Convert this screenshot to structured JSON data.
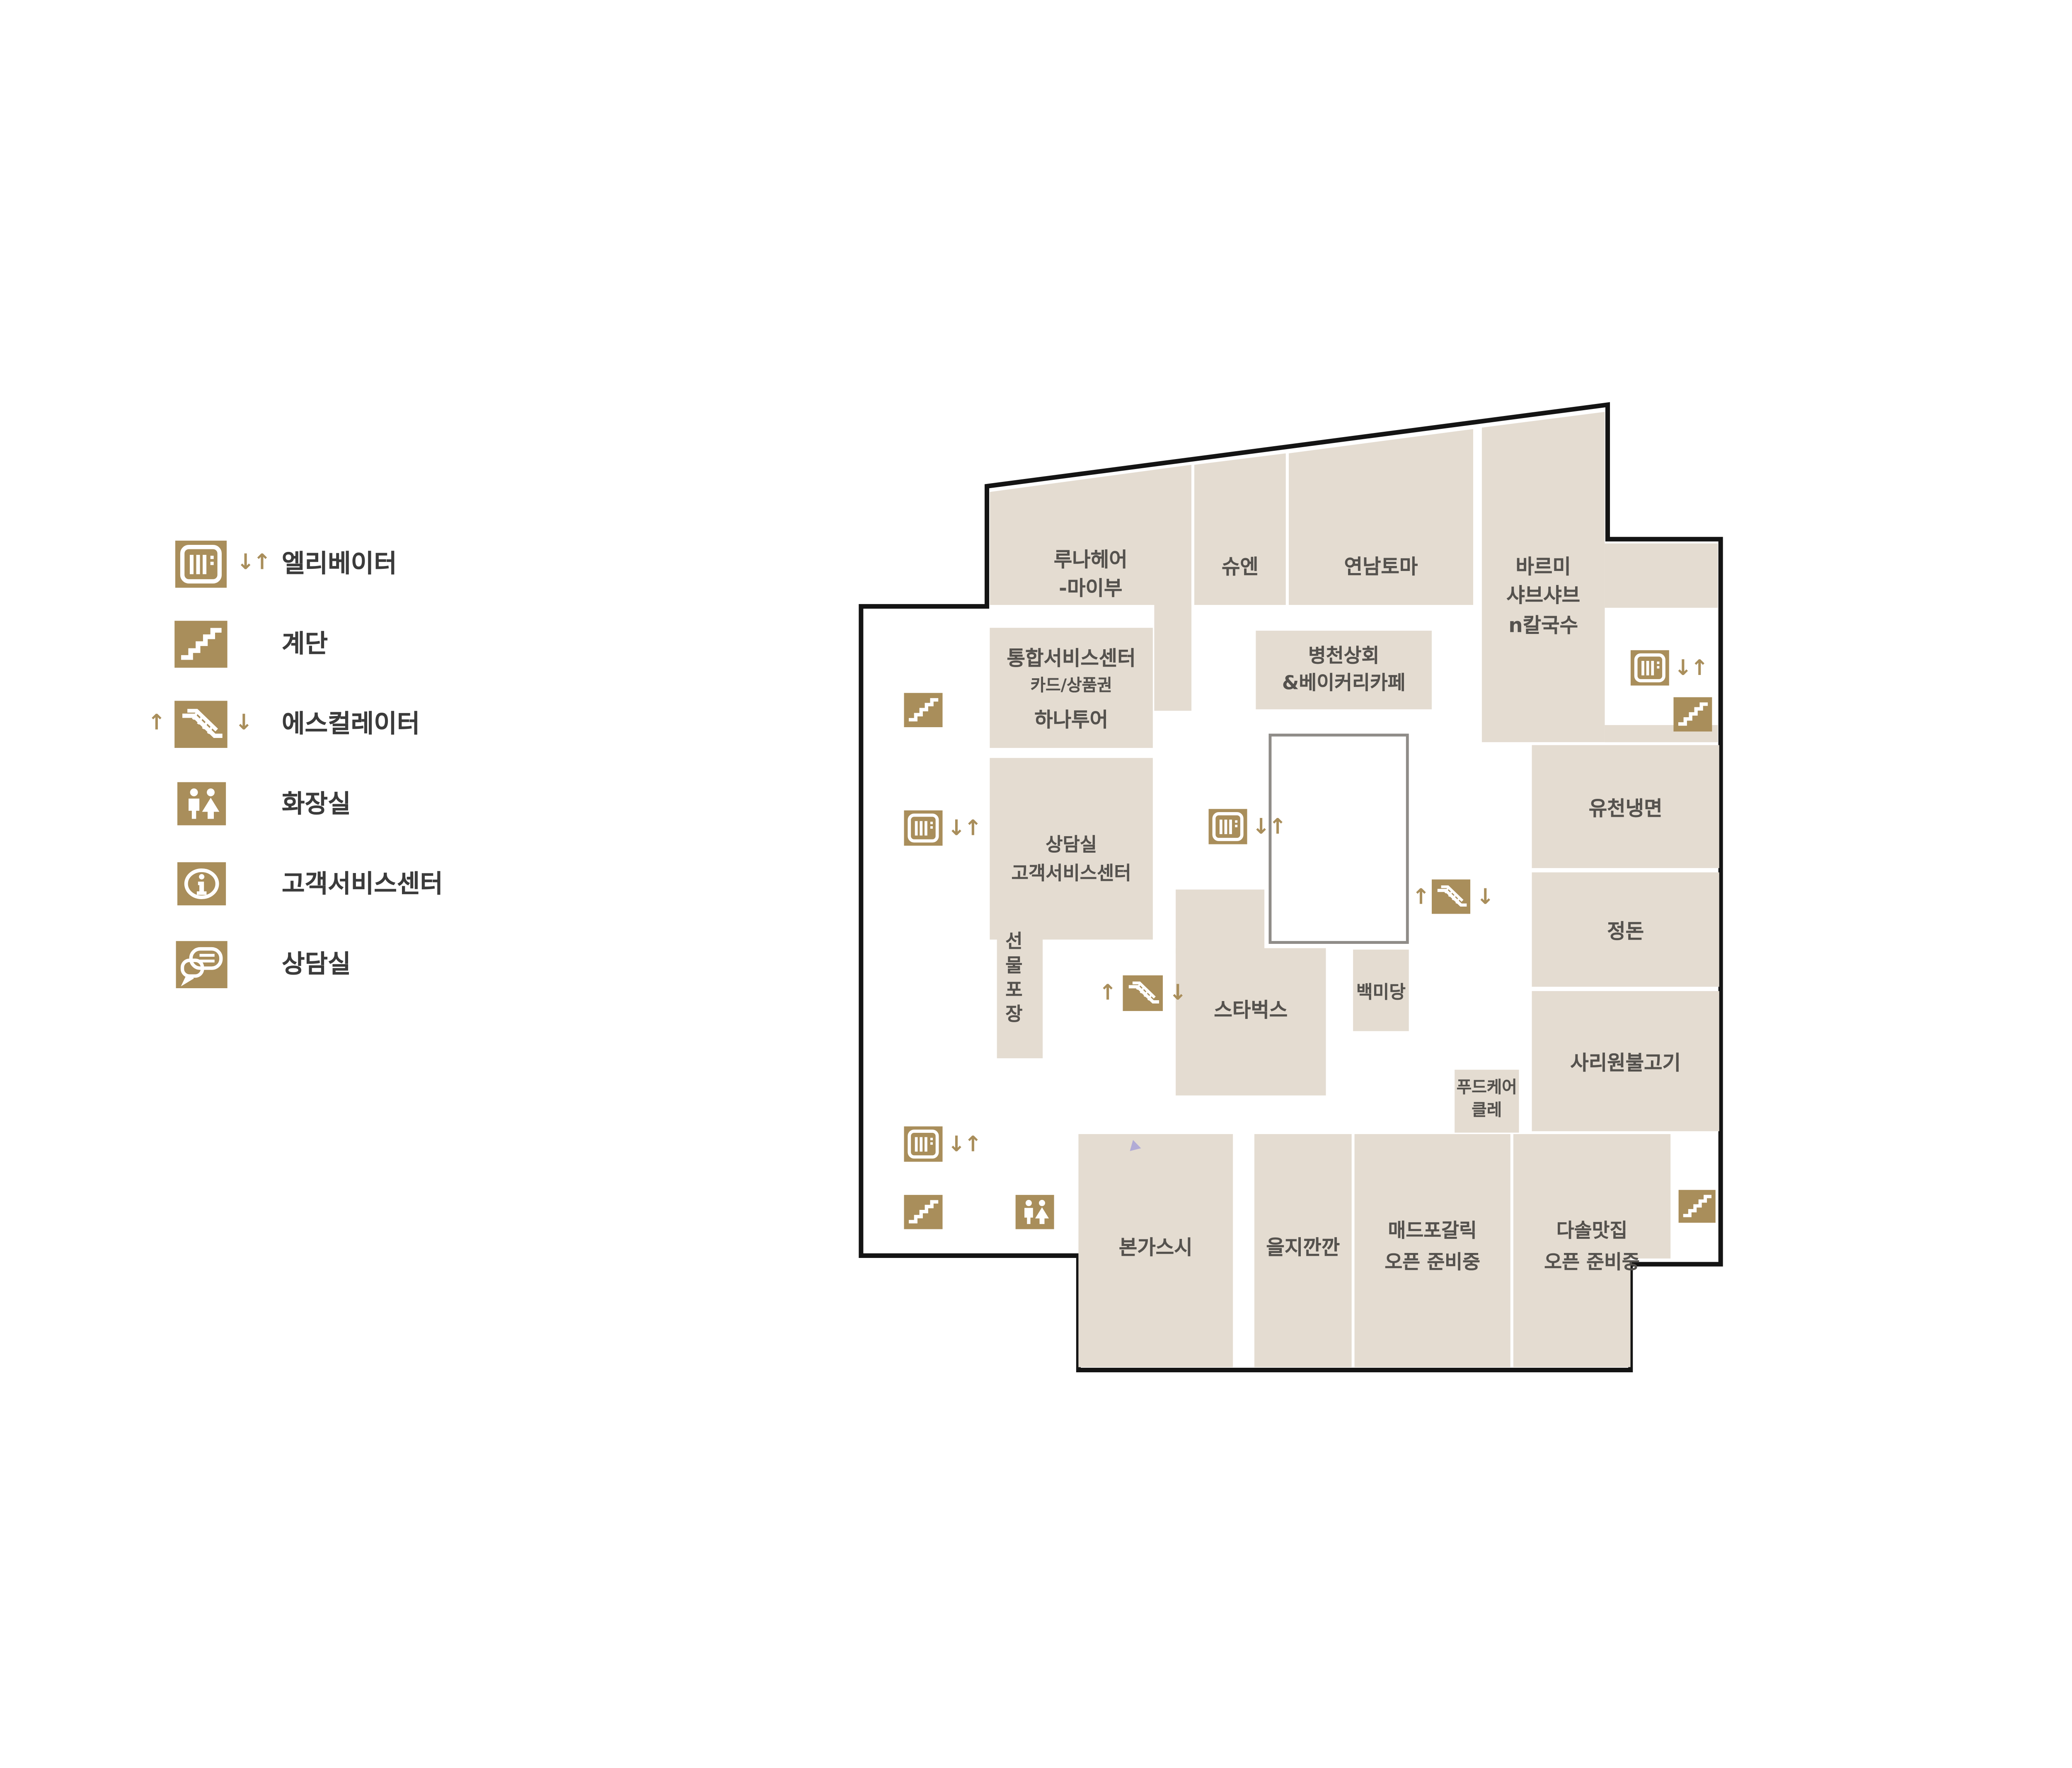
{
  "colors": {
    "accent_brown": "#a98e5b",
    "block_beige": "#e4dcd1",
    "outline_black": "#141414",
    "label_gray": "#55524e",
    "atrium_border_gray": "#8f8c88"
  },
  "legend": {
    "items": [
      {
        "icon": "elevator-icon",
        "label": "엘리베이터",
        "arrows_right": "↓↑"
      },
      {
        "icon": "stairs-icon",
        "label": "계단"
      },
      {
        "icon": "escalator-icon",
        "label": "에스컬레이터",
        "arrow_left": "↑",
        "arrow_right": "↓"
      },
      {
        "icon": "restroom-icon",
        "label": "화장실"
      },
      {
        "icon": "info-icon",
        "label": "고객서비스센터"
      },
      {
        "icon": "consult-icon",
        "label": "상담실"
      }
    ]
  },
  "map": {
    "arrows": {
      "down_up": "↓↑",
      "up": "↑",
      "down": "↓"
    },
    "stores": {
      "luna": {
        "label": "루나헤어\n-마이부"
      },
      "shuen": {
        "label": "슈엔"
      },
      "yeonnam": {
        "label": "연남토마"
      },
      "bareumi": {
        "label": "바르미\n샤브샤브\nn칼국수"
      },
      "tonghap": {
        "line1": "통합서비스센터",
        "line2": "카드/상품권",
        "line3": "하나투어"
      },
      "byeongcheon": {
        "label": "병천상회\n&베이커리카페"
      },
      "sangdam": {
        "line1": "상담실",
        "line2": "고객서비스센터"
      },
      "gift": {
        "label": "선물포장"
      },
      "starbucks": {
        "label": "스타벅스"
      },
      "baekmidang": {
        "label": "백미당"
      },
      "yucheon": {
        "label": "유천냉면"
      },
      "jeongdon": {
        "label": "정돈"
      },
      "sariwon": {
        "label": "사리원불고기"
      },
      "foodcare": {
        "label": "푸드케어\n클레"
      },
      "bonga": {
        "label": "본가스시"
      },
      "eulji": {
        "label": "을지깐깐"
      },
      "madpo": {
        "label": "매드포갈릭\n오픈 준비중"
      },
      "dasol": {
        "label": "다솔맛집\n오픈 준비중"
      }
    }
  }
}
